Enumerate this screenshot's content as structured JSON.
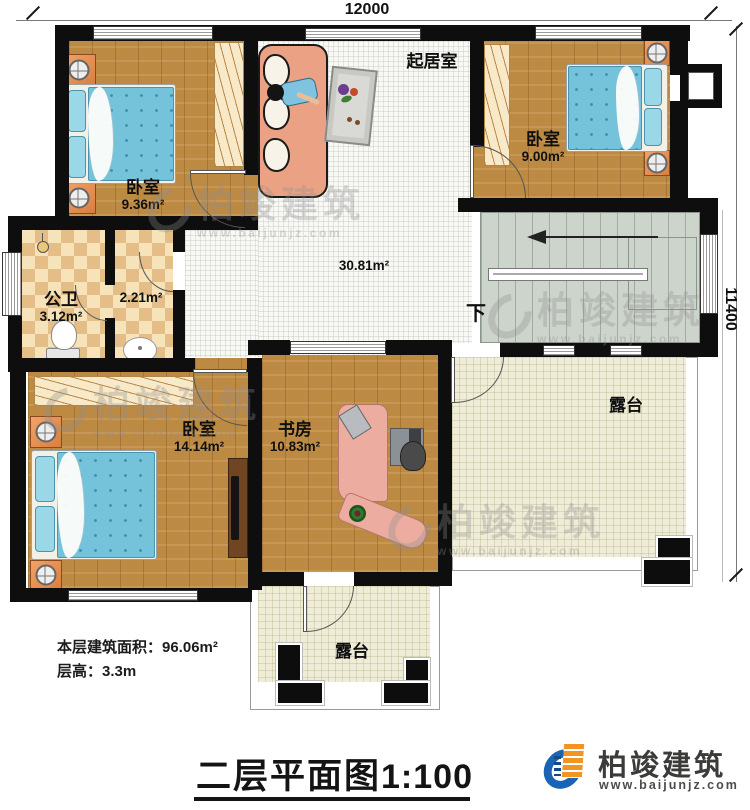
{
  "dimensions": {
    "width_mm": "12000",
    "height_mm": "11400"
  },
  "rooms": {
    "living": {
      "name": "起居室",
      "area": "30.81m²"
    },
    "bedroom_tl": {
      "name": "卧室",
      "area": "9.36m²"
    },
    "bedroom_tr": {
      "name": "卧室",
      "area": "9.00m²"
    },
    "bedroom_bl": {
      "name": "卧室",
      "area": "14.14m²"
    },
    "study": {
      "name": "书房",
      "area": "10.83m²"
    },
    "bath": {
      "name": "公卫",
      "area": "3.12m²"
    },
    "wash": {
      "area": "2.21m²"
    },
    "terrace_right": {
      "name": "露台"
    },
    "terrace_bottom": {
      "name": "露台"
    }
  },
  "stairs": {
    "down_label": "下"
  },
  "notes": {
    "area": "本层建筑面积：96.06m²",
    "height": "层高：3.3m"
  },
  "title": {
    "name": "二层平面图",
    "scale": "1:100"
  },
  "brand": {
    "name": "柏竣建筑",
    "url": "www.baijunjz.com"
  },
  "colors": {
    "wall": "#0e0e0e",
    "wood_floor": "#bd8a44",
    "tile_dark": "#e4bd87",
    "tile_light": "#f6e3ba",
    "bed_blue": "#74c3da",
    "stairs_green": "#cdd4cb",
    "terrace_cream": "#efecd8",
    "nightstand_orange": "#e89254",
    "sofa_salmon": "#eba183",
    "desk_pink": "#ecac9f",
    "brand_blue": "#1b63b5",
    "brand_orange": "#f29422"
  }
}
